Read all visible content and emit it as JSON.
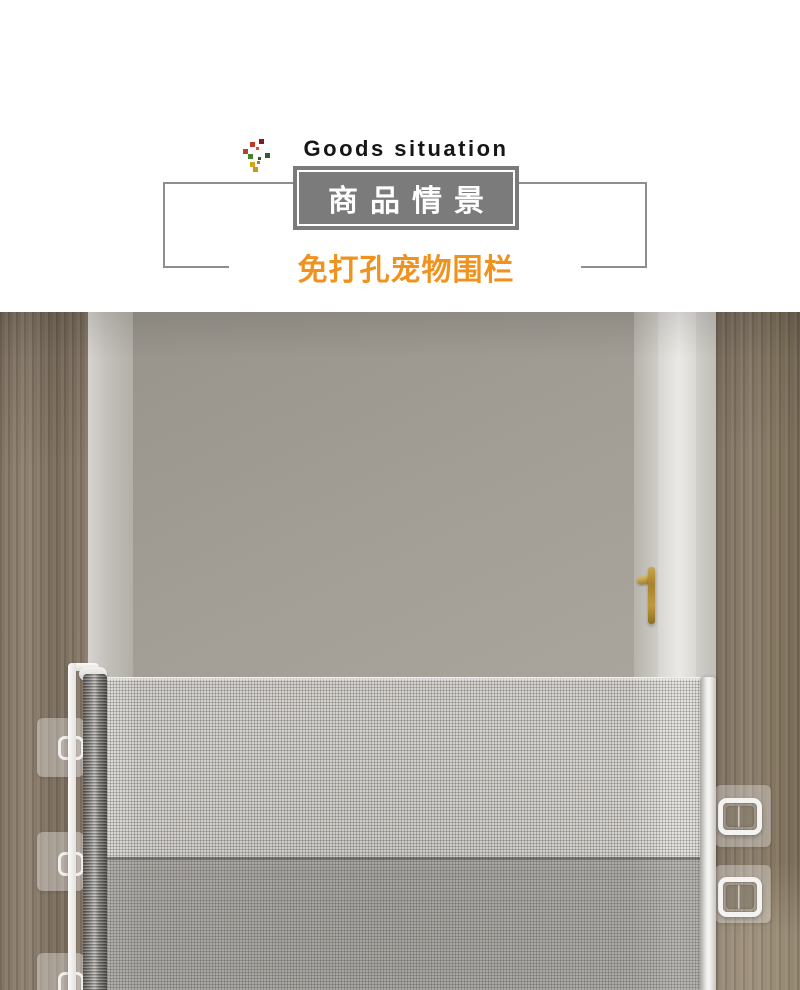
{
  "header": {
    "decor_icon": "confetti-sprig-icon",
    "subtitle_en": "Goods situation",
    "title_cn": "商品情景",
    "tagline_cn": "免打孔宠物围栏",
    "colors": {
      "title_box_bg": "#7b7b7b",
      "title_box_border": "#ffffff",
      "title_text": "#ffffff",
      "subtitle_text": "#161616",
      "tagline_text": "#f0921e",
      "frame_line": "#8e8e8e"
    }
  },
  "photo": {
    "scene": "Open doorway with wood frames and gray door; white retractable mesh pet gate mounted with adhesive brackets",
    "elements": {
      "door_handle_icon": "gold-lever-handle",
      "gate_mesh": "retractable-mesh-screen",
      "roller": "mesh-roller-post",
      "left_brackets_count": 3,
      "right_brackets_count": 2
    },
    "colors": {
      "wood": "#87796a",
      "wall": "#a6a29b",
      "door_edge": "#e8e6e2",
      "mesh": "#d6d4d0",
      "rail": "#f3f2ef",
      "handle_gold": "#b5913c",
      "shadow_band": "#6e6b66"
    }
  }
}
